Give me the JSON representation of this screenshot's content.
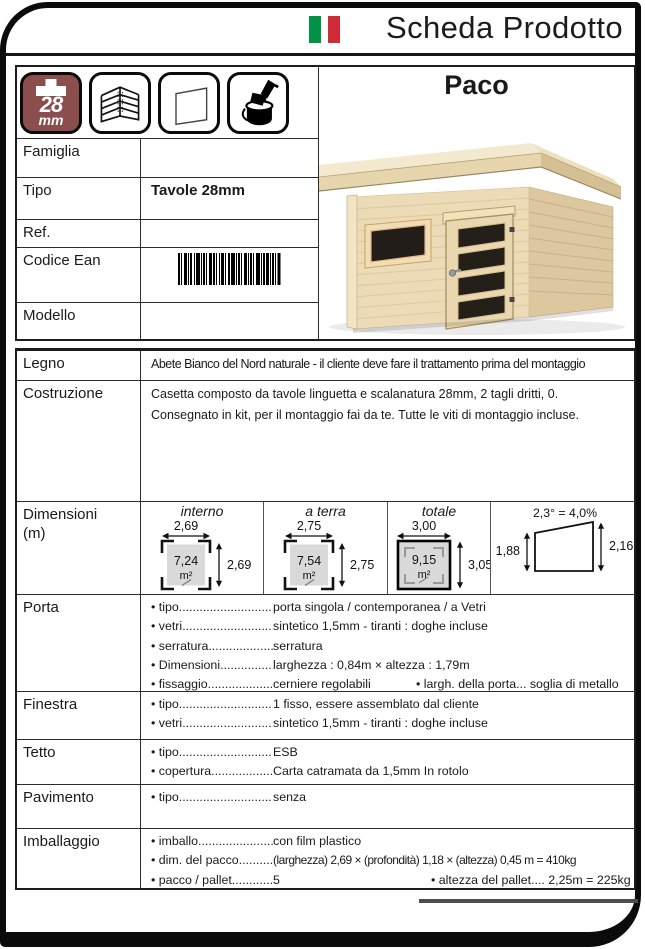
{
  "header": {
    "title": "Scheda Prodotto"
  },
  "product": {
    "name": "Paco"
  },
  "thickness_icon": {
    "value": "28",
    "unit": "mm"
  },
  "info": {
    "rows": [
      {
        "label": "Famiglia",
        "value": ""
      },
      {
        "label": "Tipo",
        "value": "Tavole 28mm"
      },
      {
        "label": "Ref.",
        "value": ""
      },
      {
        "label": "Codice Ean",
        "value": ""
      },
      {
        "label": "Modello",
        "value": ""
      }
    ]
  },
  "specs": {
    "legno": {
      "label": "Legno",
      "value": "Abete Bianco del Nord naturale - il cliente deve fare il trattamento prima del montaggio"
    },
    "costruzione": {
      "label": "Costruzione",
      "line1": "Casetta composto da tavole linguetta e scalanatura 28mm, 2 tagli dritti, 0.",
      "line2": "Consegnato in kit, per il montaggio fai da te. Tutte le viti di montaggio incluse."
    },
    "dimensioni": {
      "label": "Dimensioni",
      "unit": "(m)",
      "interno": {
        "title": "interno",
        "width": "2,69",
        "area": "7,24",
        "area_unit": "m²",
        "height": "2,69"
      },
      "a_terra": {
        "title": "a terra",
        "width": "2,75",
        "area": "7,54",
        "area_unit": "m²",
        "height": "2,75"
      },
      "totale": {
        "title": "totale",
        "width": "3,00",
        "area": "9,15",
        "area_unit": "m²",
        "height": "3,05"
      },
      "slope": {
        "angle": "2,3° = 4,0%",
        "left_height": "1,88",
        "right_height": "2,16"
      }
    },
    "porta": {
      "label": "Porta",
      "rows": [
        {
          "label": "• tipo................................",
          "value": "porta singola / contemporanea / a Vetri"
        },
        {
          "label": "• vetri...............................",
          "value": "sintetico 1,5mm  - tiranti : doghe incluse"
        },
        {
          "label": "• serratura........................",
          "value": "serratura"
        },
        {
          "label": "• Dimensioni.....................",
          "value": "larghezza : 0,84m × altezza : 1,79m"
        },
        {
          "label": "• fissaggio.........................",
          "value": "cerniere regolabili",
          "extra": "• largh. della porta...  soglia di metallo"
        }
      ]
    },
    "finestra": {
      "label": "Finestra",
      "rows": [
        {
          "label": "• tipo................................",
          "value": "1 fisso, essere assemblato dal cliente"
        },
        {
          "label": "• vetri...............................",
          "value": "sintetico 1,5mm  - tiranti : doghe incluse"
        }
      ]
    },
    "tetto": {
      "label": "Tetto",
      "rows": [
        {
          "label": "• tipo................................",
          "value": "ESB"
        },
        {
          "label": "• copertura.......................",
          "value": "Carta catramata da 1,5mm In rotolo"
        }
      ]
    },
    "pavimento": {
      "label": "Pavimento",
      "rows": [
        {
          "label": "• tipo................................",
          "value": "senza"
        }
      ]
    },
    "imballaggio": {
      "label": "Imballaggio",
      "rows": [
        {
          "label": "• imballo...........................",
          "value": "con film plastico"
        },
        {
          "label": "• dim. del pacco...............",
          "value": "(larghezza) 2,69 × (profondità) 1,18 × (altezza) 0,45 m  =  410kg"
        },
        {
          "label": "• pacco / pallet.................",
          "value": "5",
          "extra": "• altezza del pallet....  2,25m = 225kg"
        }
      ]
    }
  },
  "colors": {
    "flag_green": "#009246",
    "flag_red": "#ce2b37",
    "icon_maroon": "#8a4f4d",
    "wood_light": "#ecdbb6",
    "glass_dark": "#221d18",
    "diagram_gray": "#d9d9d9"
  }
}
